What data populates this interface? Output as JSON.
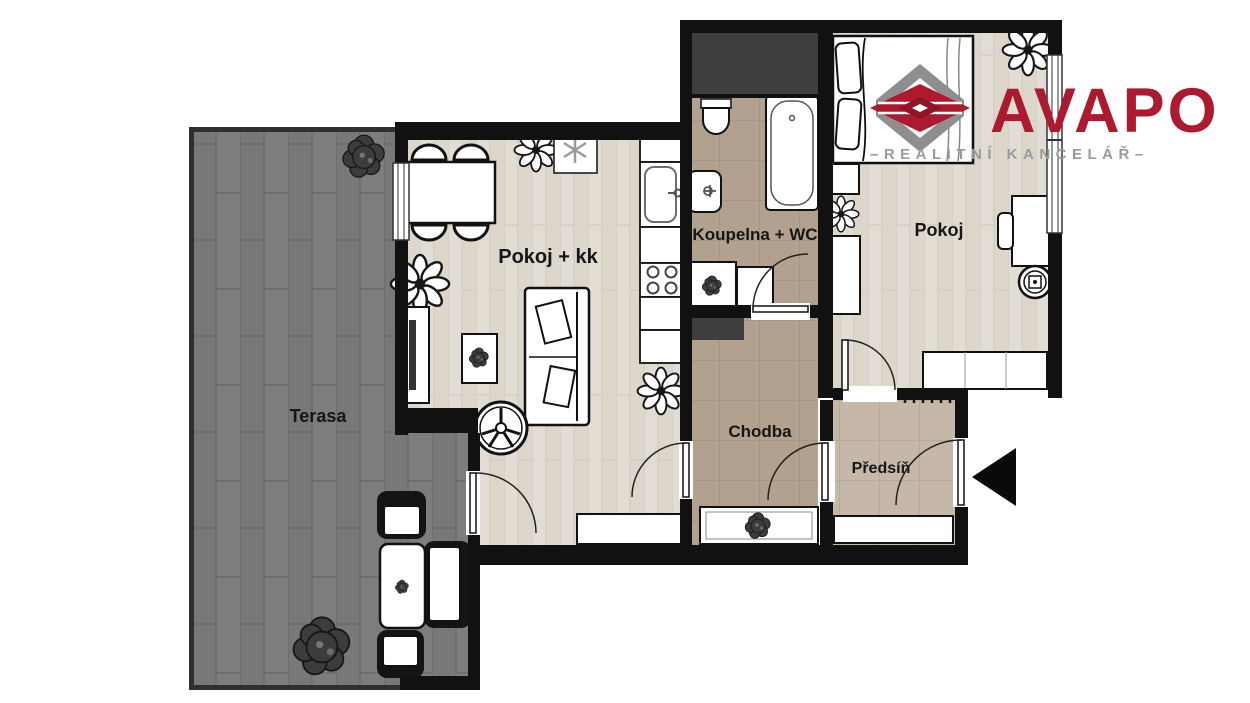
{
  "brand": {
    "name": "AVAPO",
    "tagline": "–REALITNÍ KANCELÁŘ–"
  },
  "rooms": {
    "living_room": {
      "label": "Pokoj + kk"
    },
    "bathroom": {
      "label": "Koupelna + WC"
    },
    "bedroom": {
      "label": "Pokoj"
    },
    "hallway": {
      "label": "Chodba"
    },
    "entry_hall": {
      "label": "Předsíň"
    },
    "terrace": {
      "label": "Terasa"
    }
  },
  "icons": {
    "entrance_arrow": "left-pointing-triangle",
    "flower_plant": "flower-top-view",
    "bush_plant": "shrub-top-view",
    "decor_star": "asterisk-ornament",
    "logo_mark": "hexagon-3d-bands"
  },
  "colors": {
    "accent_red": "#ab1a2e",
    "logo_gray": "#8e8e8e",
    "wall": "#111111",
    "wood_floor": "#e2ddd4",
    "tile_brown": "#b2a18e",
    "tile_entry": "#c6b8a8",
    "terrace_gray": "#7d7d7d",
    "shaft_gray": "#3e3e3e"
  }
}
